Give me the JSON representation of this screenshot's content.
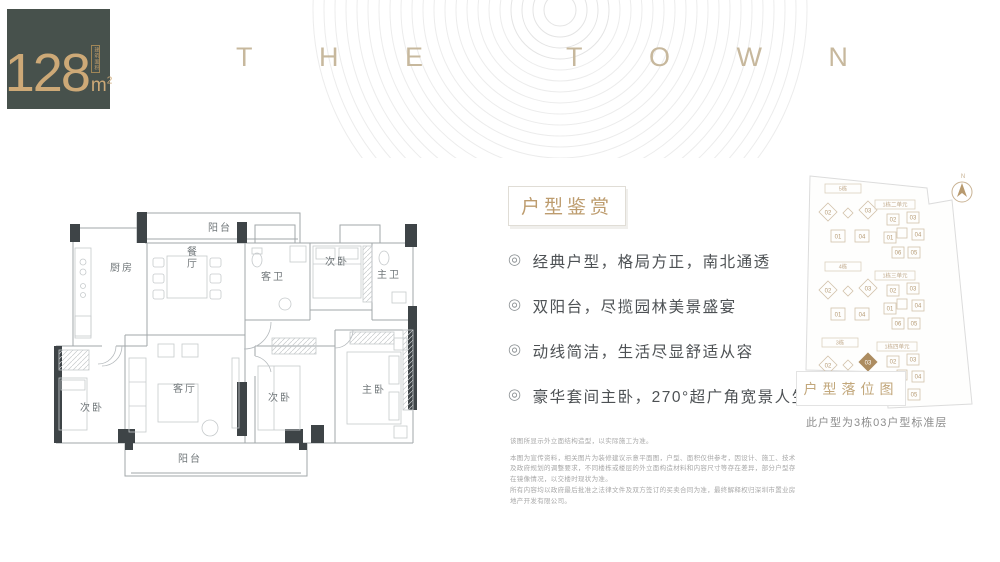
{
  "badge": {
    "area_number": "128",
    "area_unit": "m",
    "area_exponent": "2",
    "seal_text": "建筑面积"
  },
  "brand": {
    "letters": [
      "T",
      "H",
      "E",
      "",
      "T",
      "O",
      "W",
      "N"
    ]
  },
  "floorplan": {
    "rooms": [
      {
        "label": "阳台"
      },
      {
        "label": "厨房"
      },
      {
        "label": "餐厅"
      },
      {
        "label": "客卫"
      },
      {
        "label": "次卧"
      },
      {
        "label": "主卫"
      },
      {
        "label": "次卧"
      },
      {
        "label": "客厅"
      },
      {
        "label": "次卧"
      },
      {
        "label": "主卧"
      },
      {
        "label": "阳台"
      }
    ]
  },
  "features": {
    "title": "户型鉴赏",
    "bullet": "◎",
    "items": [
      "经典户型，格局方正，南北通透",
      "双阳台，尽揽园林美景盛宴",
      "动线简洁，生活尽显舒适从容",
      "豪华套间主卧，270°超广角宽景人生"
    ]
  },
  "siteplan": {
    "compass_label": "N",
    "clusters": [
      {
        "label": "5栋",
        "units": [
          "02",
          "03",
          "01",
          "04"
        ]
      },
      {
        "label": "4栋",
        "units": [
          "02",
          "03",
          "01",
          "04"
        ]
      },
      {
        "label": "3栋",
        "units": [
          "02",
          "03",
          "01",
          "04"
        ],
        "highlight": "03"
      },
      {
        "label": "1栋二单元",
        "units": [
          "02",
          "03",
          "01",
          "04",
          "06",
          "05"
        ]
      },
      {
        "label": "1栋三单元",
        "units": [
          "02",
          "03",
          "01",
          "04",
          "06",
          "05"
        ]
      },
      {
        "label": "1栋四单元",
        "units": [
          "02",
          "03",
          "01",
          "04",
          "06",
          "05"
        ]
      }
    ],
    "legend": "户型落位图",
    "caption": "此户型为3栋03户型标准层"
  },
  "disclaimer": {
    "line1": "该图所显示外立面结构造型，以实际施工为准。",
    "para1": "本图为宣传资料，相关图片为装修建议示意平面图，户型、面积仅供参考，因设计、施工、技术及政府规划的调整要求，不同楼栋或楼层的外立面构造材料和内容尺寸等存在差异，部分户型存在镜像情况，以交楼时现状为准。",
    "para2": "所有内容均以政府最后批准之法律文件及双方签订的买卖合同为准，最终解释权归深圳市置业房地产开发有限公司。"
  },
  "colors": {
    "badge_background": "#47514c",
    "gold_accent": "#cda977",
    "brand_letters": "#c7b89d",
    "feature_title": "#bd9c6e",
    "feature_text": "#4d5154",
    "plan_wall_dark": "#3e4447",
    "plan_line": "#a2a7aa",
    "site_outline": "#d2c2ab",
    "site_highlight": "#ac8c60"
  }
}
